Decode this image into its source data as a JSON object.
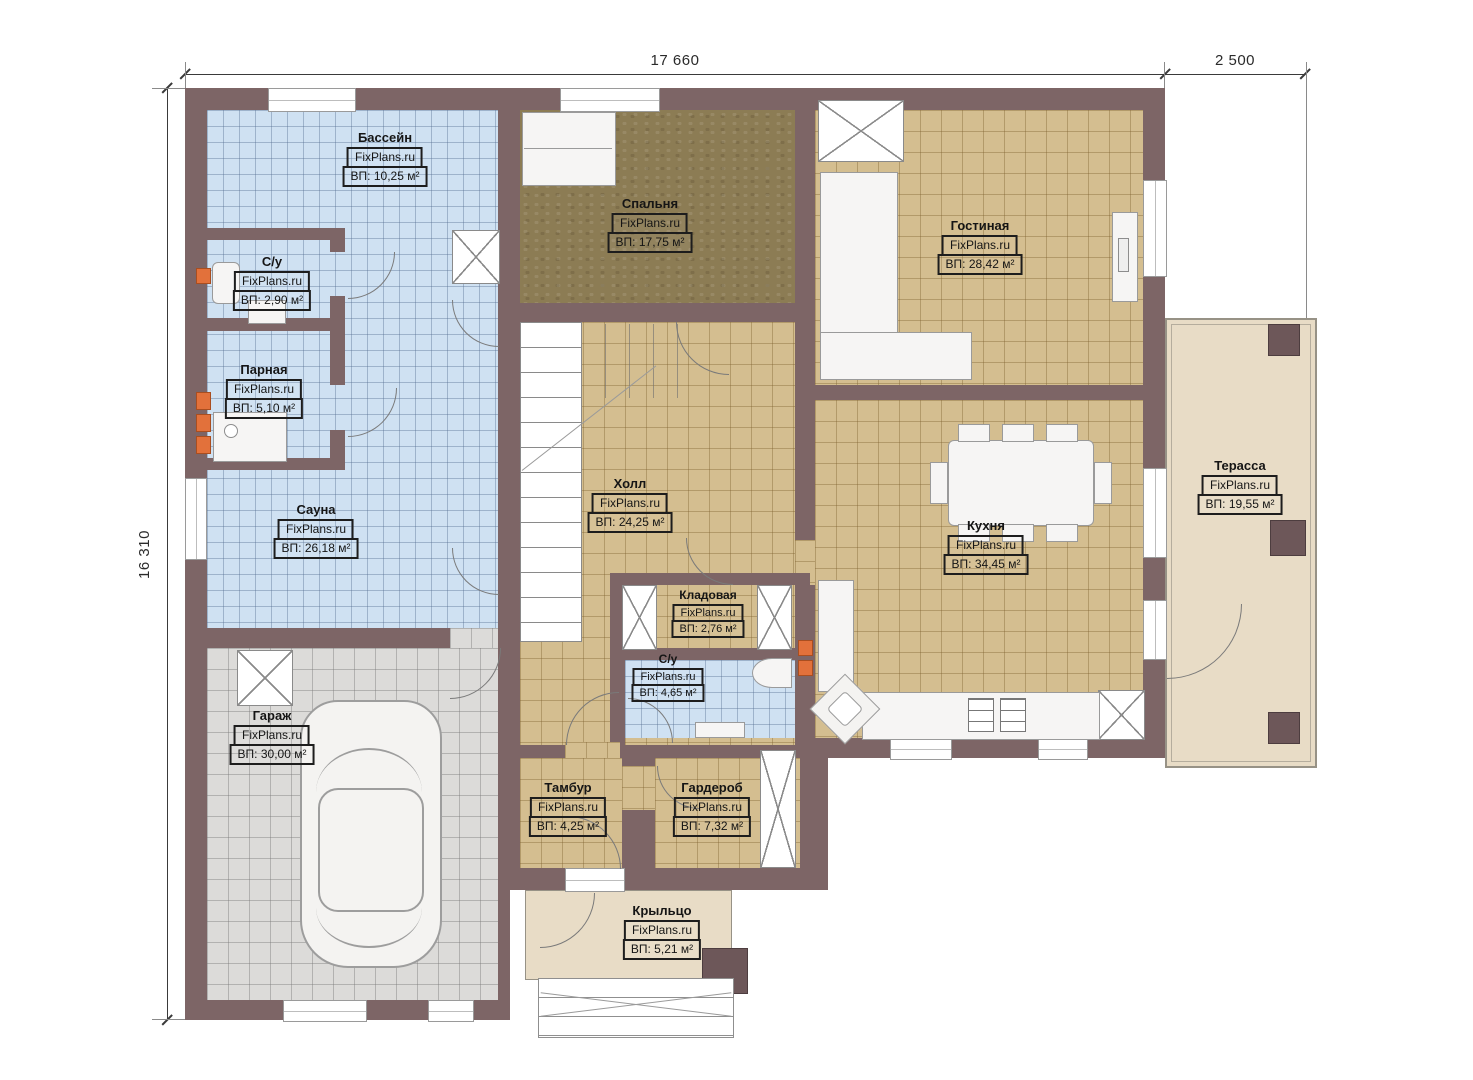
{
  "branding": {
    "watermark": "FixPlans.ru"
  },
  "dimensions": {
    "top_main": "17 660",
    "top_right": "2 500",
    "left": "16 310"
  },
  "rooms": [
    {
      "id": "pool",
      "name": "Бассейн",
      "area": "ВП: 10,25 м²"
    },
    {
      "id": "wc1",
      "name": "С/у",
      "area": "ВП: 2,90 м²"
    },
    {
      "id": "steam",
      "name": "Парная",
      "area": "ВП: 5,10 м²"
    },
    {
      "id": "sauna",
      "name": "Сауна",
      "area": "ВП: 26,18 м²"
    },
    {
      "id": "garage",
      "name": "Гараж",
      "area": "ВП: 30,00 м²"
    },
    {
      "id": "bedroom",
      "name": "Спальня",
      "area": "ВП: 17,75 м²"
    },
    {
      "id": "living",
      "name": "Гостиная",
      "area": "ВП: 28,42 м²"
    },
    {
      "id": "hall",
      "name": "Холл",
      "area": "ВП: 24,25 м²"
    },
    {
      "id": "kitchen",
      "name": "Кухня",
      "area": "ВП: 34,45 м²"
    },
    {
      "id": "pantry",
      "name": "Кладовая",
      "area": "ВП: 2,76 м²"
    },
    {
      "id": "wc2",
      "name": "С/у",
      "area": "ВП: 4,65 м²"
    },
    {
      "id": "vestibule",
      "name": "Тамбур",
      "area": "ВП: 4,25 м²"
    },
    {
      "id": "wardrobe",
      "name": "Гардероб",
      "area": "ВП: 7,32 м²"
    },
    {
      "id": "terrace",
      "name": "Терасса",
      "area": "ВП: 19,55 м²"
    },
    {
      "id": "porch",
      "name": "Крыльцо",
      "area": "ВП: 5,21 м²"
    }
  ],
  "colors": {
    "wall": "#7d6566",
    "pool_floor": "#cfe1f2",
    "tile_floor": "#d4be90",
    "garage_floor": "#dcdbd9",
    "bedroom_floor": "#8c7c54",
    "terrace_floor": "#e8dcc6",
    "accent_radiator": "#e2713b"
  }
}
